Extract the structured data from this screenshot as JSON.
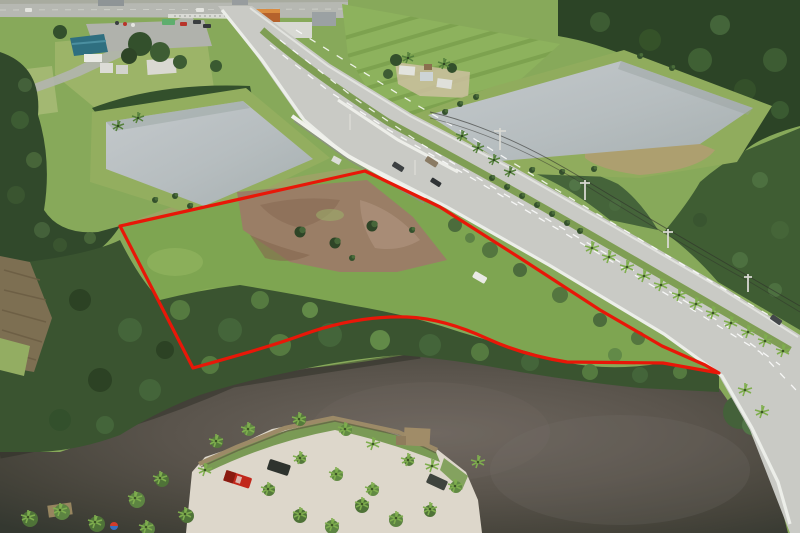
{
  "scene": {
    "kind": "aerial-drone-photograph",
    "subject": "vacant waterfront land parcel outlined with red boundary line",
    "elements": {
      "boundary": "red-property-boundary",
      "highway": "divided-highway-with-palm-median",
      "bridge": "concrete-bridge-barriers",
      "pond_left": "rectangular-retention-pond",
      "pond_right": "retention-pond-with-grass-berm",
      "river": "dark-tannin-river",
      "shore": "sandy-boat-launch-with-docks",
      "parcel_surface": "cleared-dirt-and-grass",
      "intersection": "signalized-road-intersection",
      "buildings": "commercial-buildings-and-houses",
      "field": "mowed-striped-field",
      "vehicles": "cars-on-road-red-pickup-dark-suv-white-car"
    }
  },
  "colors": {
    "boundary": "#e81708",
    "grass": "#87a95a",
    "grass_light": "#97b264",
    "road": "#c9cac5",
    "road_edge": "#eceee9",
    "pond": "#b9bfc1",
    "river_dark": "#3a3d33",
    "river_mid": "#5a544c",
    "sand": "#ddd7cb",
    "forest": "#2e4627",
    "canopy": "#3a5430",
    "dirt": "#9a7e66",
    "dry_grass": "#b39c72",
    "truck_red": "#c1271b",
    "dock_wood": "#9c8a67",
    "suv_dark": "#2e332e",
    "white_car": "#e9eae4"
  }
}
